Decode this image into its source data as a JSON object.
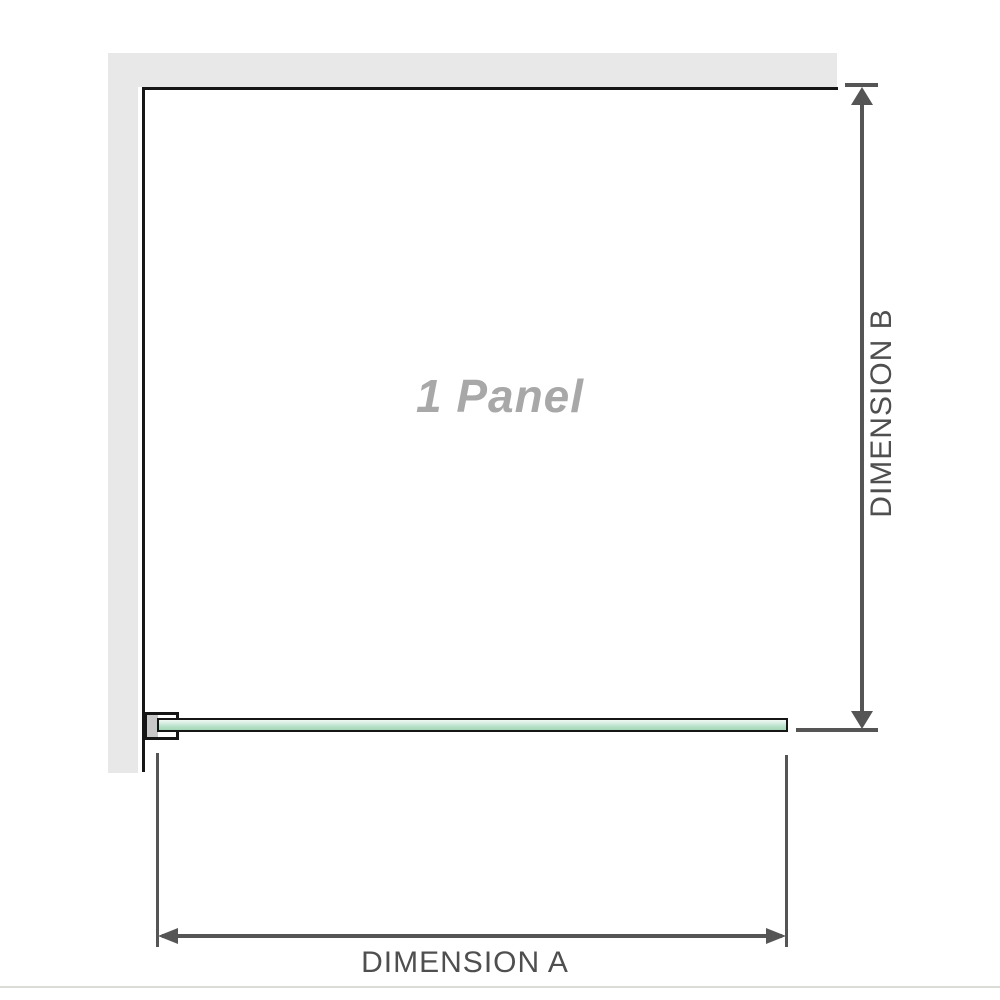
{
  "diagram": {
    "panel_label": "1 Panel",
    "dimension_a_label": "DIMENSION A",
    "dimension_b_label": "DIMENSION B"
  },
  "colors": {
    "wall_fill": "#e8e8e8",
    "panel_outline": "#161616",
    "glass_fill_light": "#f1f9f4",
    "glass_fill_dark": "#a3d6b6",
    "bracket_pad_fill": "#c9c9c9",
    "dimension_line": "#555555",
    "dimension_label_text": "#4f4f4f",
    "panel_label_text": "#a8a8a8",
    "page_divider": "#d9ddd5"
  }
}
